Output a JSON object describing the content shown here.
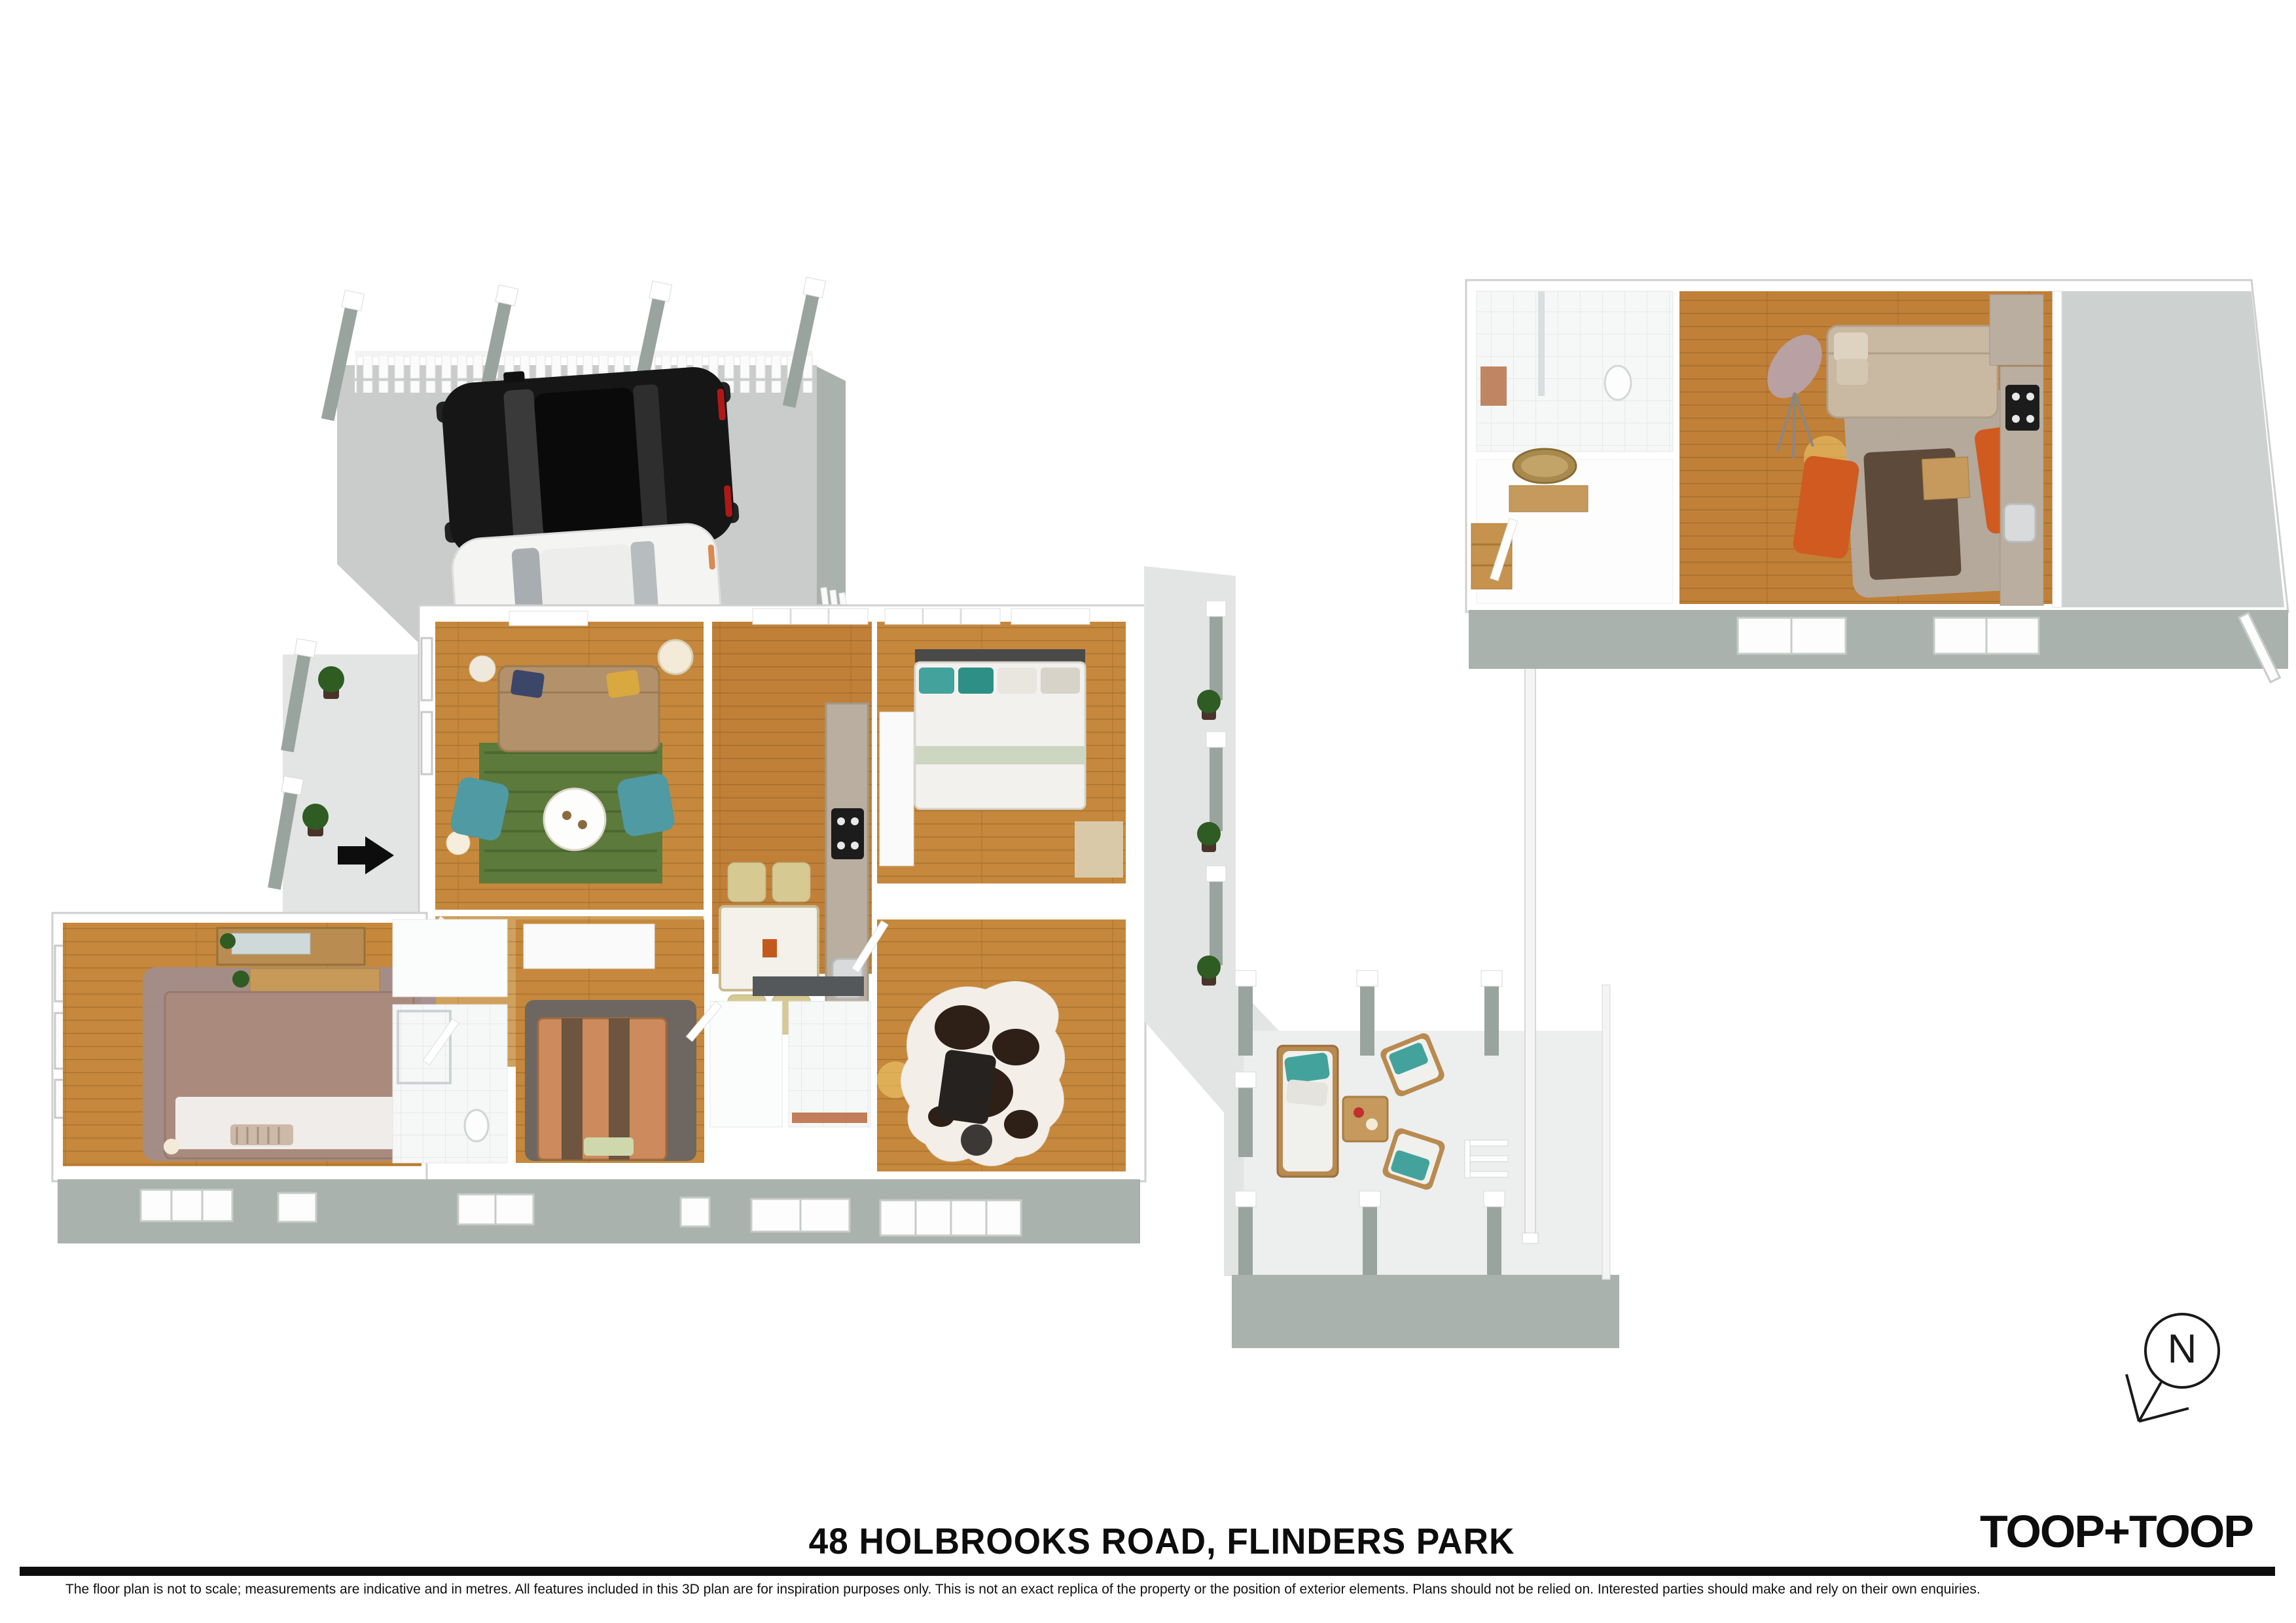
{
  "document": {
    "kind": "3d-floor-plan-marketing-page"
  },
  "footer": {
    "title": "48 HOLBROOKS ROAD, FLINDERS PARK",
    "logo": "TOOP+TOOP",
    "disclaimer": "The floor plan is not to scale; measurements are indicative and in metres. All features included in this 3D plan are for inspiration purposes only. This is not an exact replica of the property or the position of exterior elements. Plans should not be relied on. Interested parties should make and rely on their own enquiries."
  },
  "north": {
    "label": "N"
  },
  "colors": {
    "wall": "#ffffff",
    "wall_stroke": "#cfcfcf",
    "sage": "#a9b2ac",
    "post": "#9aa49e",
    "concrete_slab": "#c9cccb",
    "concrete_path": "#e3e5e4",
    "patio": "#edeeee",
    "wood": "#c5883c",
    "wood_light": "#cfa15c",
    "wood_mid": "#c08038",
    "rug_green": "#5c7a3c",
    "teal": "#4f9aa3",
    "teal_pillow": "#43a39c",
    "sofa_tan": "#b3916a",
    "cream": "#d6c991",
    "counter": "#b9ae9f",
    "marble": "#f3f1ea",
    "orange": "#d05a1f",
    "ottoman": "#5d4a3a",
    "rug_gray": "#b3aca4",
    "bed_mauve": "#ab8a7e",
    "rug_mauve": "#a28d8a",
    "bed_orange": "#cd8a5c",
    "stripe": "#6d553f",
    "duvet": "#f2f1ee",
    "tile": "#f6f7f7",
    "car_black": "#161616",
    "car_white": "#f4f4f3",
    "terracotta": "#b9683f",
    "cowhide": "#2f2017",
    "ink": "#111111"
  },
  "scene": {
    "main_house": {
      "rooms": [
        "carport",
        "living-room",
        "hallway",
        "kitchen-dining",
        "bedroom-1",
        "master-bedroom",
        "bathroom",
        "bedroom-2",
        "wc",
        "laundry",
        "study-bedroom"
      ],
      "furniture": [
        "black-suv",
        "white-sedan",
        "tan-sofa",
        "green-rug",
        "round-coffee-table",
        "teal-armchairs",
        "console-with-mirror",
        "dining-table",
        "cream-chairs",
        "kitchen-counter-with-cooktop-and-sink",
        "double-bed-white-duvet",
        "mauve-double-bed",
        "dresser-with-mirror",
        "striped-single-bed",
        "cowhide-rug",
        "desk-chair"
      ]
    },
    "rear_studio": {
      "rooms": [
        "bathroom",
        "entry-hall",
        "living-kitchen",
        "utility-room"
      ],
      "furniture": [
        "beige-sofa",
        "tripod-lamp",
        "orange-armchairs",
        "brown-ottoman",
        "gray-rug",
        "kitchen-counter",
        "oval-mirror"
      ]
    },
    "outdoor": [
      "concrete-paths",
      "pergola-posts",
      "potted-plants",
      "picket-fence",
      "long-boundary-fence",
      "patio-lounge-set",
      "entry-arrow"
    ]
  }
}
